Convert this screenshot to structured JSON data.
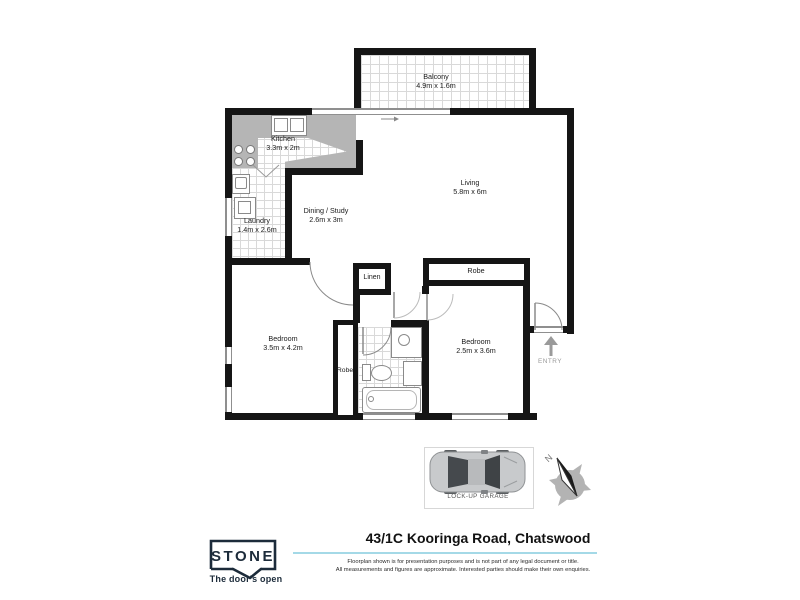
{
  "floorplan": {
    "rooms": {
      "balcony": {
        "name": "Balcony",
        "dims": "4.9m x 1.6m"
      },
      "kitchen": {
        "name": "Kitchen",
        "dims": "3.3m x 2m"
      },
      "laundry": {
        "name": "Laundry",
        "dims": "1.4m x 2.6m"
      },
      "dining": {
        "name": "Dining / Study",
        "dims": "2.6m x 3m"
      },
      "living": {
        "name": "Living",
        "dims": "5.8m x 6m"
      },
      "bedroom1": {
        "name": "Bedroom",
        "dims": "3.5m x 4.2m"
      },
      "bedroom2": {
        "name": "Bedroom",
        "dims": "2.5m x 3.6m"
      },
      "linen": {
        "name": "Linen"
      },
      "robe_bedroom1": {
        "name": "Robe"
      },
      "robe_bedroom2": {
        "name": "Robe"
      }
    },
    "entry_label": "ENTRY",
    "garage_label": "LOCK-UP GARAGE",
    "compass_north": "N",
    "wall_color": "#151515"
  },
  "footer": {
    "address_title": "43/1C Kooringa Road, Chatswood",
    "disclaimer_line1": "Floorplan shown is for presentation purposes and is not part of any legal document or title.",
    "disclaimer_line2": "All measurements and figures are approximate. Interested parties should make their own enquiries.",
    "accent_line_color": "#a4d9e7",
    "brand": {
      "logo_text": "STONE",
      "tagline": "The door's open",
      "color": "#1c2b3a"
    }
  }
}
